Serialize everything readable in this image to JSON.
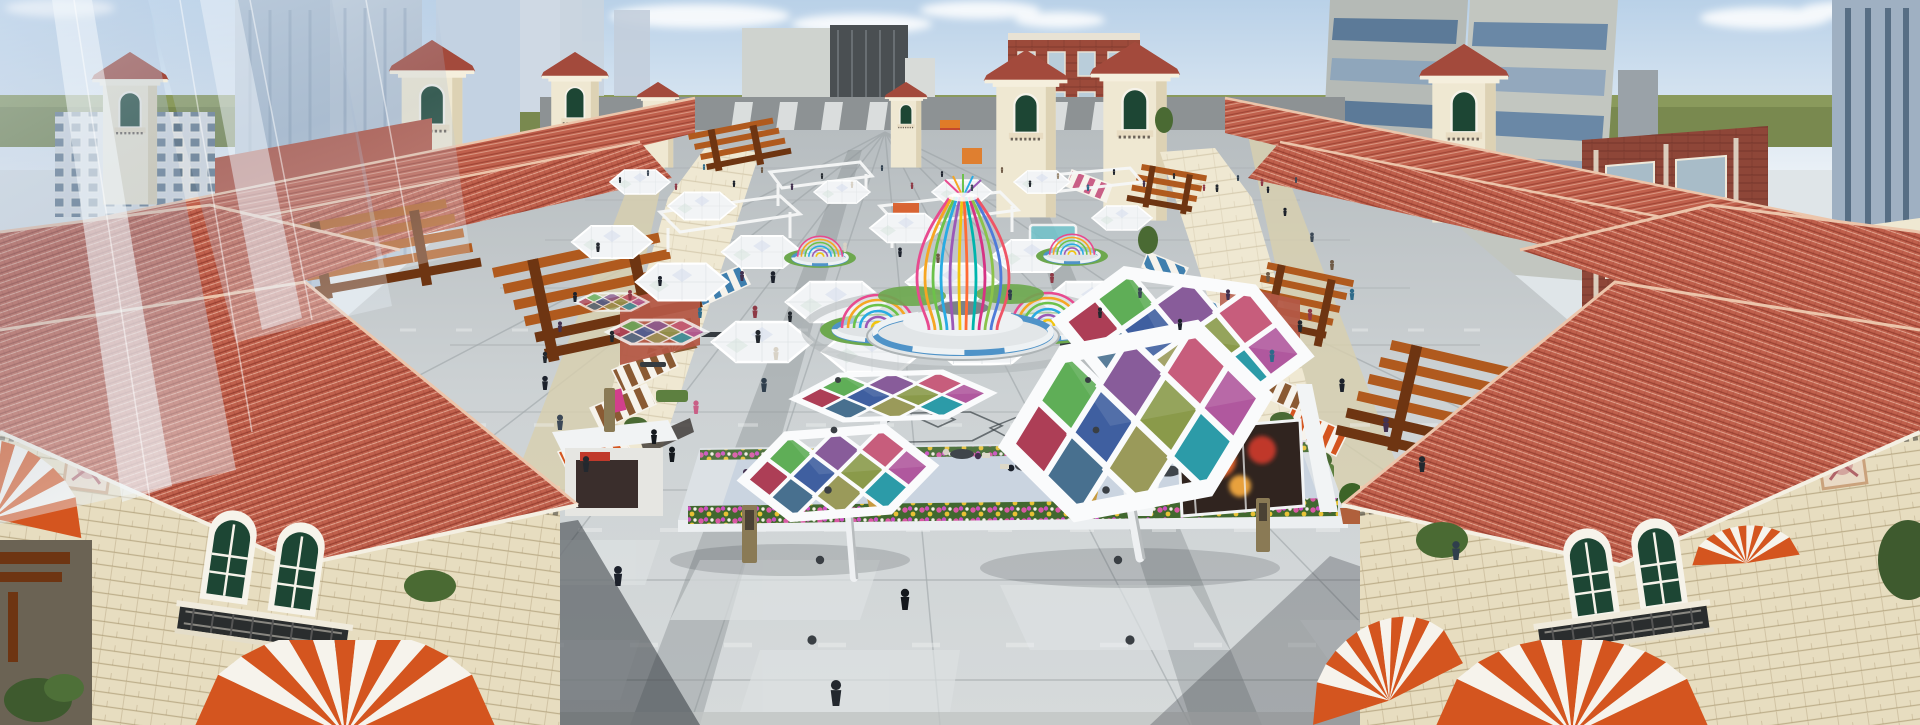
{
  "scene": {
    "subject": "aerial rendering of a mediterranean-style pedestrian shopping plaza",
    "landmarks": [
      "rainbow-vase-pavilion",
      "rainbow-dome-pavilions",
      "colored-hex-canopies",
      "striped-dome-awnings",
      "cafe-terrace",
      "tile-roof-towers",
      "glass-skyscraper",
      "modern-high-rises"
    ]
  },
  "palette": {
    "sky_top": "#b9d1e8",
    "sky_bot": "#e9f0f6",
    "cloud": "#ffffff",
    "horizon": "#79894f",
    "horizon_light": "#8a9a5c",
    "roof": "#c0604c",
    "roof_dark": "#a34a3c",
    "roof_light": "#d98a70",
    "roof_ridge": "#ecc5ab",
    "roof_far": "#b35846",
    "wall": "#efe8d2",
    "wall_shade": "#ddd2b4",
    "wall_dark": "#c9bc9c",
    "stone": "#e7ddc0",
    "cornice": "#f3e9d4",
    "trim_peach": "#f0cfae",
    "win_green": "#1d4634",
    "win_frame": "#f6f3ea",
    "iron": "#1f2326",
    "glass": "#b7c9de",
    "glass_hi": "#eef4fa",
    "slab": "#cfd3cf",
    "slab_dark": "#4a4f52",
    "brick": "#9c4a3a",
    "brick_light": "#ae5a46",
    "brick_win": "#b9cdda",
    "twr_grey": "#b5bab6",
    "twr_band": "#5c7a98",
    "twr_band2": "#8fa6bb",
    "paving": "#c9ced0",
    "paving_light": "#dde1e2",
    "paving_dark": "#8e9597",
    "paving_tan": "#d8cfae",
    "asphalt": "#8d9294",
    "shadow": "#272d33",
    "awn_red": "#d4551f",
    "awn_blue": "#3f7fae",
    "awn_brown": "#8a5a33",
    "awn_pink": "#c95f86",
    "awn_white": "#f6f3ec",
    "pergola": "#b05a1e",
    "pergola_dark": "#6e3512",
    "grass": "#6da84e",
    "tree": "#4a6a33",
    "tree_light": "#5d8040",
    "planter_blue": "#4f93c8",
    "bed": "#41682f",
    "flower_pink": "#d959a4",
    "flower_yellow": "#e8c235",
    "flower_magenta": "#cc4fc0",
    "white": "#f4f6f7",
    "frame_white": "#fafbfc",
    "wire": "#3a4146",
    "p1": "#ad3e56",
    "p2": "#3f5fa0",
    "p3": "#8a9a4a",
    "p4": "#b0589e",
    "p5": "#5fae57",
    "p6": "#7b4a8f",
    "p7": "#c14b6e",
    "p8": "#48708f",
    "p9": "#9a9a5a",
    "p10": "#2c9ba8",
    "r1": "#e84a8f",
    "r2": "#f6a623",
    "r3": "#6cc24a",
    "r4": "#29abe2",
    "r5": "#9b59b6",
    "r6": "#f1c40f",
    "r7": "#ff6b35",
    "r8": "#00b5ad",
    "r9": "#d63384",
    "r10": "#8bc34a",
    "r11": "#4f7bd9",
    "r12": "#ef5466",
    "kiosk_orange": "#e2622b",
    "kiosk_red": "#c0392b",
    "kiosk_amber": "#e8a13c",
    "sign_pink": "#d23f8c"
  },
  "figures": [
    {
      "x": 620,
      "y": 183,
      "s": 0.5,
      "c": "#23282e"
    },
    {
      "x": 648,
      "y": 176,
      "s": 0.5,
      "c": "#3c4856"
    },
    {
      "x": 676,
      "y": 190,
      "s": 0.55,
      "c": "#8e3a46"
    },
    {
      "x": 704,
      "y": 170,
      "s": 0.5,
      "c": "#2e6b8a"
    },
    {
      "x": 734,
      "y": 187,
      "s": 0.55,
      "c": "#1c212b"
    },
    {
      "x": 762,
      "y": 173,
      "s": 0.5,
      "c": "#6e5a46"
    },
    {
      "x": 792,
      "y": 190,
      "s": 0.55,
      "c": "#43314f"
    },
    {
      "x": 822,
      "y": 179,
      "s": 0.5,
      "c": "#23282e"
    },
    {
      "x": 852,
      "y": 188,
      "s": 0.55,
      "c": "#d8d2c6"
    },
    {
      "x": 882,
      "y": 171,
      "s": 0.5,
      "c": "#2f3e4c"
    },
    {
      "x": 912,
      "y": 189,
      "s": 0.55,
      "c": "#8e3a46"
    },
    {
      "x": 942,
      "y": 177,
      "s": 0.5,
      "c": "#1c212b"
    },
    {
      "x": 972,
      "y": 191,
      "s": 0.55,
      "c": "#3c4856"
    },
    {
      "x": 1002,
      "y": 173,
      "s": 0.5,
      "c": "#6e5a46"
    },
    {
      "x": 1030,
      "y": 187,
      "s": 0.55,
      "c": "#23282e"
    },
    {
      "x": 1058,
      "y": 179,
      "s": 0.5,
      "c": "#9a8872"
    },
    {
      "x": 1088,
      "y": 191,
      "s": 0.55,
      "c": "#2e6b8a"
    },
    {
      "x": 1114,
      "y": 175,
      "s": 0.5,
      "c": "#1c212b"
    },
    {
      "x": 1144,
      "y": 187,
      "s": 0.55,
      "c": "#43314f"
    },
    {
      "x": 1174,
      "y": 179,
      "s": 0.5,
      "c": "#23282e"
    },
    {
      "x": 1204,
      "y": 191,
      "s": 0.55,
      "c": "#8e3a46"
    },
    {
      "x": 1238,
      "y": 181,
      "s": 0.5,
      "c": "#2f3e4c"
    },
    {
      "x": 1268,
      "y": 193,
      "s": 0.55,
      "c": "#1c212b"
    },
    {
      "x": 1296,
      "y": 183,
      "s": 0.5,
      "c": "#3c4856"
    },
    {
      "x": 598,
      "y": 252,
      "s": 0.8,
      "c": "#23282e"
    },
    {
      "x": 630,
      "y": 300,
      "s": 0.85,
      "c": "#8e3a46"
    },
    {
      "x": 660,
      "y": 286,
      "s": 0.85,
      "c": "#1c212b"
    },
    {
      "x": 700,
      "y": 318,
      "s": 0.9,
      "c": "#2e6b8a"
    },
    {
      "x": 742,
      "y": 281,
      "s": 0.85,
      "c": "#43314f"
    },
    {
      "x": 790,
      "y": 322,
      "s": 0.9,
      "c": "#23282e"
    },
    {
      "x": 845,
      "y": 252,
      "s": 0.8,
      "c": "#d8d2c6"
    },
    {
      "x": 900,
      "y": 257,
      "s": 0.8,
      "c": "#1c212b"
    },
    {
      "x": 938,
      "y": 263,
      "s": 0.8,
      "c": "#6e5a46"
    },
    {
      "x": 1010,
      "y": 300,
      "s": 0.9,
      "c": "#2f3e4c"
    },
    {
      "x": 1052,
      "y": 283,
      "s": 0.85,
      "c": "#8e3a46"
    },
    {
      "x": 1100,
      "y": 318,
      "s": 0.9,
      "c": "#23282e"
    },
    {
      "x": 1140,
      "y": 298,
      "s": 0.9,
      "c": "#3c4856"
    },
    {
      "x": 1180,
      "y": 330,
      "s": 0.95,
      "c": "#1c212b"
    },
    {
      "x": 1228,
      "y": 300,
      "s": 0.9,
      "c": "#43314f"
    },
    {
      "x": 1268,
      "y": 282,
      "s": 0.85,
      "c": "#6e5a46"
    },
    {
      "x": 612,
      "y": 342,
      "s": 0.95,
      "c": "#23282e"
    },
    {
      "x": 1310,
      "y": 320,
      "s": 0.95,
      "c": "#8e3a46"
    },
    {
      "x": 1352,
      "y": 300,
      "s": 0.95,
      "c": "#2e6b8a"
    },
    {
      "x": 575,
      "y": 302,
      "s": 0.85,
      "c": "#1c212b"
    },
    {
      "x": 560,
      "y": 332,
      "s": 0.9,
      "c": "#43314f"
    },
    {
      "x": 545,
      "y": 363,
      "s": 0.95,
      "c": "#23282e"
    },
    {
      "x": 773,
      "y": 283,
      "s": 1.0,
      "c": "#1c212b"
    },
    {
      "x": 755,
      "y": 318,
      "s": 1.05,
      "c": "#8e3a46"
    },
    {
      "x": 758,
      "y": 343,
      "s": 1.1,
      "c": "#23282e"
    },
    {
      "x": 776,
      "y": 360,
      "s": 1.1,
      "c": "#d8d2c6"
    },
    {
      "x": 764,
      "y": 392,
      "s": 1.2,
      "c": "#2f3e4c"
    },
    {
      "x": 696,
      "y": 414,
      "s": 1.15,
      "c": "#c95f86"
    },
    {
      "x": 1217,
      "y": 192,
      "s": 0.65,
      "c": "#23282e"
    },
    {
      "x": 1262,
      "y": 186,
      "s": 0.6,
      "c": "#8e3a46"
    },
    {
      "x": 1285,
      "y": 216,
      "s": 0.7,
      "c": "#1c212b"
    },
    {
      "x": 1312,
      "y": 242,
      "s": 0.8,
      "c": "#3c4856"
    },
    {
      "x": 1332,
      "y": 270,
      "s": 0.85,
      "c": "#6e5a46"
    },
    {
      "x": 1300,
      "y": 332,
      "s": 1.0,
      "c": "#23282e"
    },
    {
      "x": 1272,
      "y": 362,
      "s": 1.05,
      "c": "#2e6b8a"
    },
    {
      "x": 1342,
      "y": 392,
      "s": 1.15,
      "c": "#1c212b"
    },
    {
      "x": 1386,
      "y": 432,
      "s": 1.25,
      "c": "#43314f"
    },
    {
      "x": 1422,
      "y": 472,
      "s": 1.35,
      "c": "#23282e"
    },
    {
      "x": 545,
      "y": 390,
      "s": 1.2,
      "c": "#1c212b"
    },
    {
      "x": 560,
      "y": 430,
      "s": 1.3,
      "c": "#3c4856"
    },
    {
      "x": 586,
      "y": 472,
      "s": 1.35,
      "c": "#23282e"
    },
    {
      "x": 672,
      "y": 462,
      "s": 1.3,
      "c": "#14181d"
    },
    {
      "x": 654,
      "y": 444,
      "s": 1.25,
      "c": "#14181d"
    },
    {
      "x": 836,
      "y": 706,
      "s": 2.2,
      "c": "#23282e"
    },
    {
      "x": 618,
      "y": 586,
      "s": 1.7,
      "c": "#1c212b"
    },
    {
      "x": 1456,
      "y": 560,
      "s": 1.6,
      "c": "#2f3e4c"
    },
    {
      "x": 905,
      "y": 610,
      "s": 1.8,
      "c": "#14181d"
    }
  ]
}
